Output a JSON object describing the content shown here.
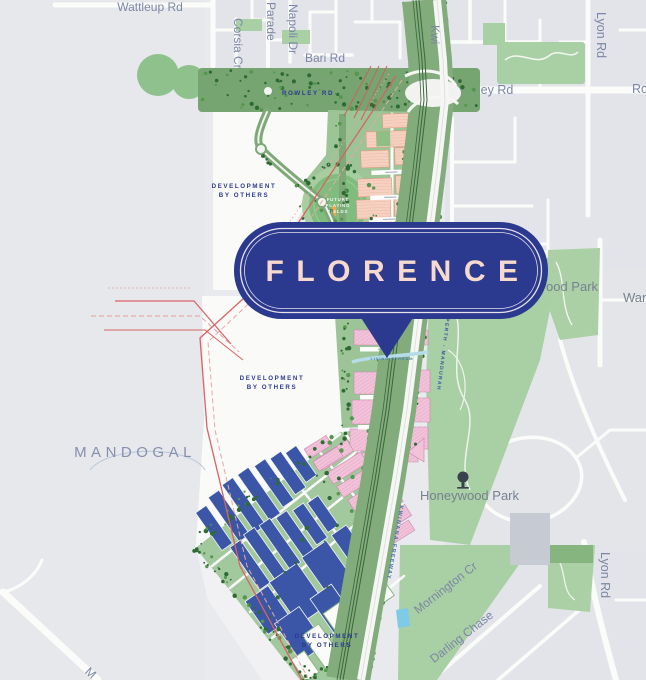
{
  "callout": {
    "label": "FLORENCE"
  },
  "roads": {
    "wattleup": "Wattleup Rd",
    "parade": "Parade",
    "napoli": "Napoli Dr",
    "corsia": "Corsia Cr",
    "bari": "Bari Rd",
    "rowley_band": "ROWLEY RD",
    "rowley_east": "ey Rd",
    "rowley_far": "Ro",
    "lyon_north": "Lyon Rd",
    "lyon_south": "Lyon Rd",
    "kwinana_abbr": "Kwi",
    "kwinana_freeway": "KWINANA FREEWAY",
    "rail_line": "PERTH - MANDURAH",
    "mornington": "Mornington Cr",
    "darling": "Darling Chase",
    "m_fragment": "M"
  },
  "places": {
    "mandogalup": "MANDOGAL",
    "honeywood": "Honeywood Park",
    "park_fragment": "ood Park",
    "wandi_fragment": "Wan",
    "living_stream": "LIVING STREAM"
  },
  "annotations": {
    "dev": {
      "l1": "DEVELOPMENT",
      "l2": "BY OTHERS"
    },
    "fields": {
      "l1": "FUTURE",
      "l2": "PLAYING",
      "l3": "FIELDS"
    }
  },
  "colors": {
    "navy": "#2b3a8f",
    "blush": "#f7d9ce",
    "ring": "#e9e2ec",
    "lot_blue": "#3b56a7",
    "lot_pink": "#f2c2d8",
    "lot_salmon": "#f6d0c0",
    "park_green": "#a9cfa4",
    "corridor_green": "#83ac7c",
    "rail_red": "#d96262"
  }
}
